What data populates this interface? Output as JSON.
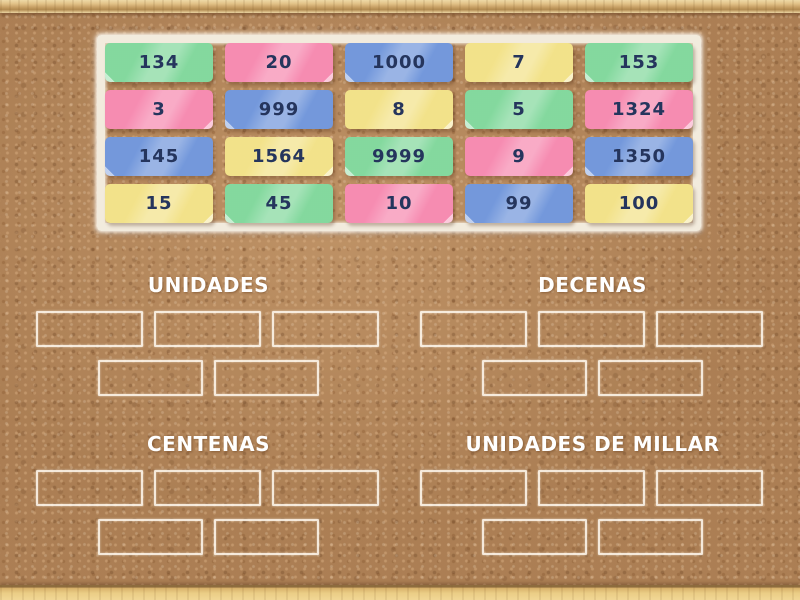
{
  "board": {
    "cards": [
      {
        "value": "134",
        "color": "green"
      },
      {
        "value": "20",
        "color": "pink"
      },
      {
        "value": "1000",
        "color": "blue"
      },
      {
        "value": "7",
        "color": "yellow"
      },
      {
        "value": "153",
        "color": "green"
      },
      {
        "value": "3",
        "color": "pink"
      },
      {
        "value": "999",
        "color": "blue"
      },
      {
        "value": "8",
        "color": "yellow"
      },
      {
        "value": "5",
        "color": "green"
      },
      {
        "value": "1324",
        "color": "pink"
      },
      {
        "value": "145",
        "color": "blue"
      },
      {
        "value": "1564",
        "color": "yellow"
      },
      {
        "value": "9999",
        "color": "green"
      },
      {
        "value": "9",
        "color": "pink"
      },
      {
        "value": "1350",
        "color": "blue"
      },
      {
        "value": "15",
        "color": "yellow"
      },
      {
        "value": "45",
        "color": "green"
      },
      {
        "value": "10",
        "color": "pink"
      },
      {
        "value": "99",
        "color": "blue"
      },
      {
        "value": "100",
        "color": "yellow"
      }
    ]
  },
  "groups": [
    {
      "label": "UNIDADES",
      "slot_rows": [
        3,
        2
      ]
    },
    {
      "label": "DECENAS",
      "slot_rows": [
        3,
        2
      ]
    },
    {
      "label": "CENTENAS",
      "slot_rows": [
        3,
        2
      ]
    },
    {
      "label": "UNIDADES DE MILLAR",
      "slot_rows": [
        3,
        2
      ]
    }
  ],
  "colors": {
    "cork": "#b7895c",
    "frame_wood": "#e2c288",
    "card_green": "#7fd79a",
    "card_pink": "#f687ae",
    "card_blue": "#6e94da",
    "card_yellow": "#f2e185",
    "card_text": "#25355d",
    "tray_paper": "#f2ebdd",
    "slot_outline": "#fff8ee",
    "label_text": "#ffffff"
  }
}
